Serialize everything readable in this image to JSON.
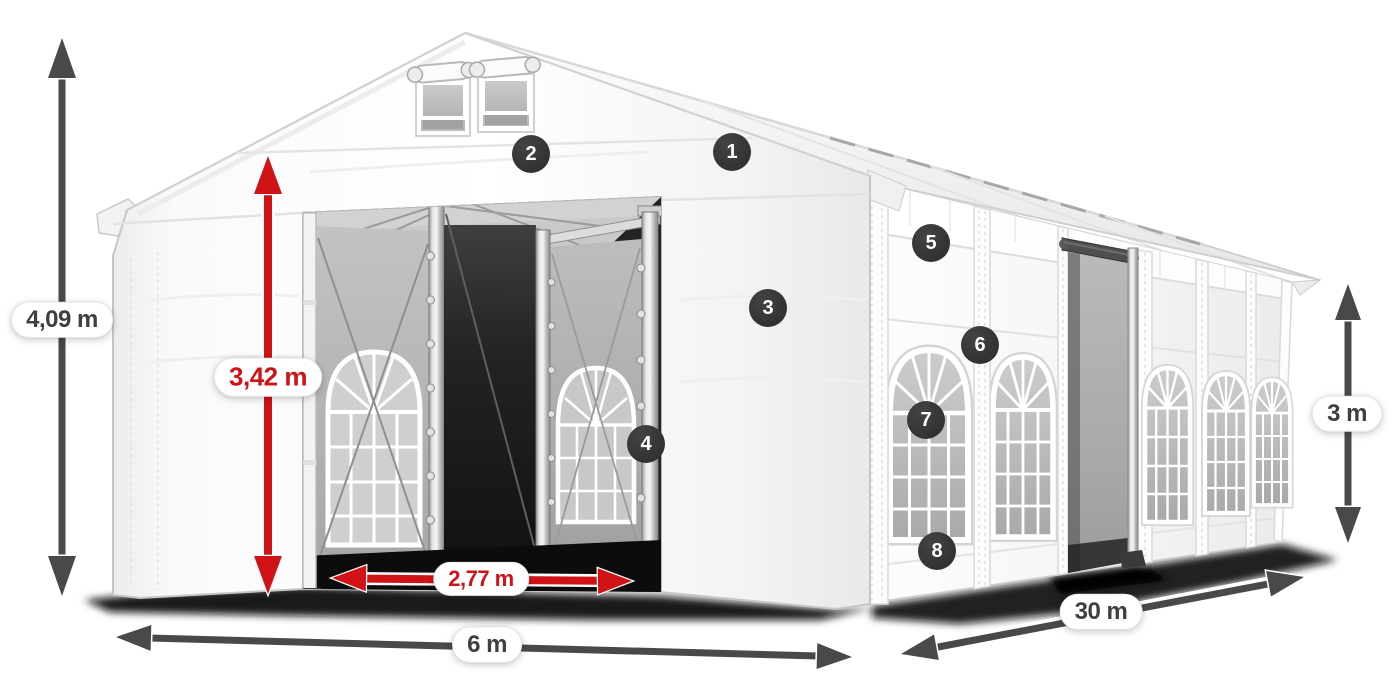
{
  "page": {
    "background": "#ffffff",
    "description": "Dimension diagram of a white 6 x 30 m gable tent with front entrance, arched side windows and numbered feature markers"
  },
  "dimensions": {
    "total_height": "4,09 m",
    "entrance_height": "3,42 m",
    "entrance_width": "2,77 m",
    "front_width": "6 m",
    "side_length": "30 m",
    "wall_height": "3 m"
  },
  "markers": [
    {
      "label": "1"
    },
    {
      "label": "2"
    },
    {
      "label": "3"
    },
    {
      "label": "4"
    },
    {
      "label": "5"
    },
    {
      "label": "6"
    },
    {
      "label": "7"
    },
    {
      "label": "8"
    }
  ],
  "colors": {
    "accent_red": "#d01317",
    "dimension_dark": "#494949",
    "badge_background": "#333333",
    "tent_white": "#ffffff"
  }
}
